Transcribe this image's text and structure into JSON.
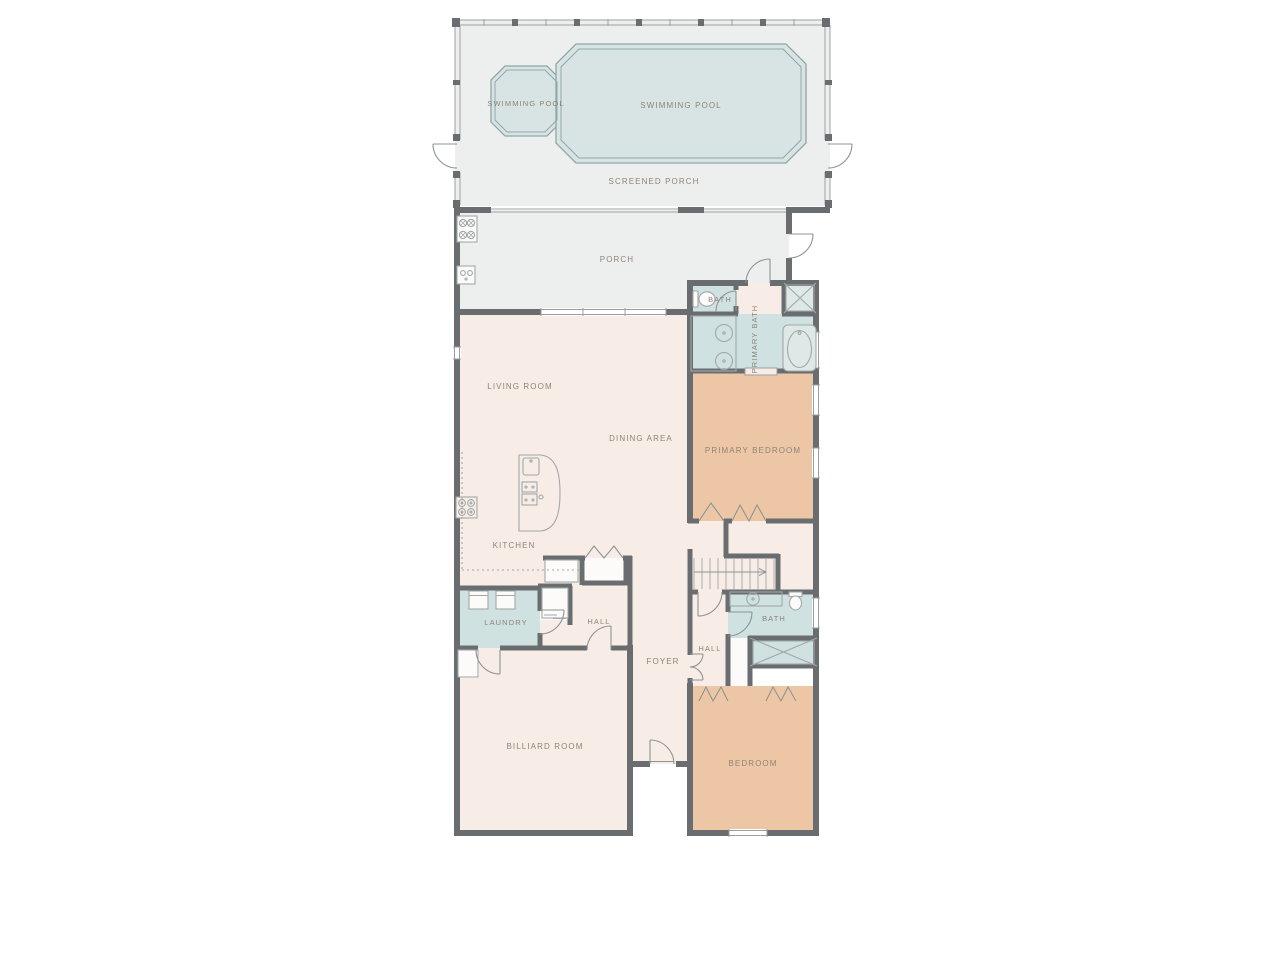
{
  "plan": {
    "type": "residential-floor-plan",
    "labels": {
      "swimming_pool_small": "SWIMMING POOL",
      "swimming_pool_main": "SWIMMING POOL",
      "screened_porch": "SCREENED PORCH",
      "porch": "PORCH",
      "bath_wc": "BATH",
      "primary_bath": "PRIMARY BATH",
      "living_room": "LIVING ROOM",
      "dining_area": "DINING AREA",
      "primary_bedroom": "PRIMARY BEDROOM",
      "kitchen": "KITCHEN",
      "laundry": "LAUNDRY",
      "hall_left": "HALL",
      "hall_right": "HALL",
      "foyer": "FOYER",
      "bath": "BATH",
      "billiard_room": "BILLIARD ROOM",
      "bedroom": "BEDROOM"
    },
    "colors": {
      "wall": "#696d70",
      "floor_main": "#f7ede6",
      "floor_bedroom": "#edc7a5",
      "floor_bath": "#cfe1e1",
      "floor_porch": "#edefee",
      "pool_water": "#d8e4e3",
      "pool_edge": "#8fa7a8",
      "closet": "#fcfbf9",
      "label_text": "#8d8478",
      "fixture_line": "#a2a8a8",
      "door_line": "#8d9494",
      "window_line": "#9aa0a0"
    }
  }
}
